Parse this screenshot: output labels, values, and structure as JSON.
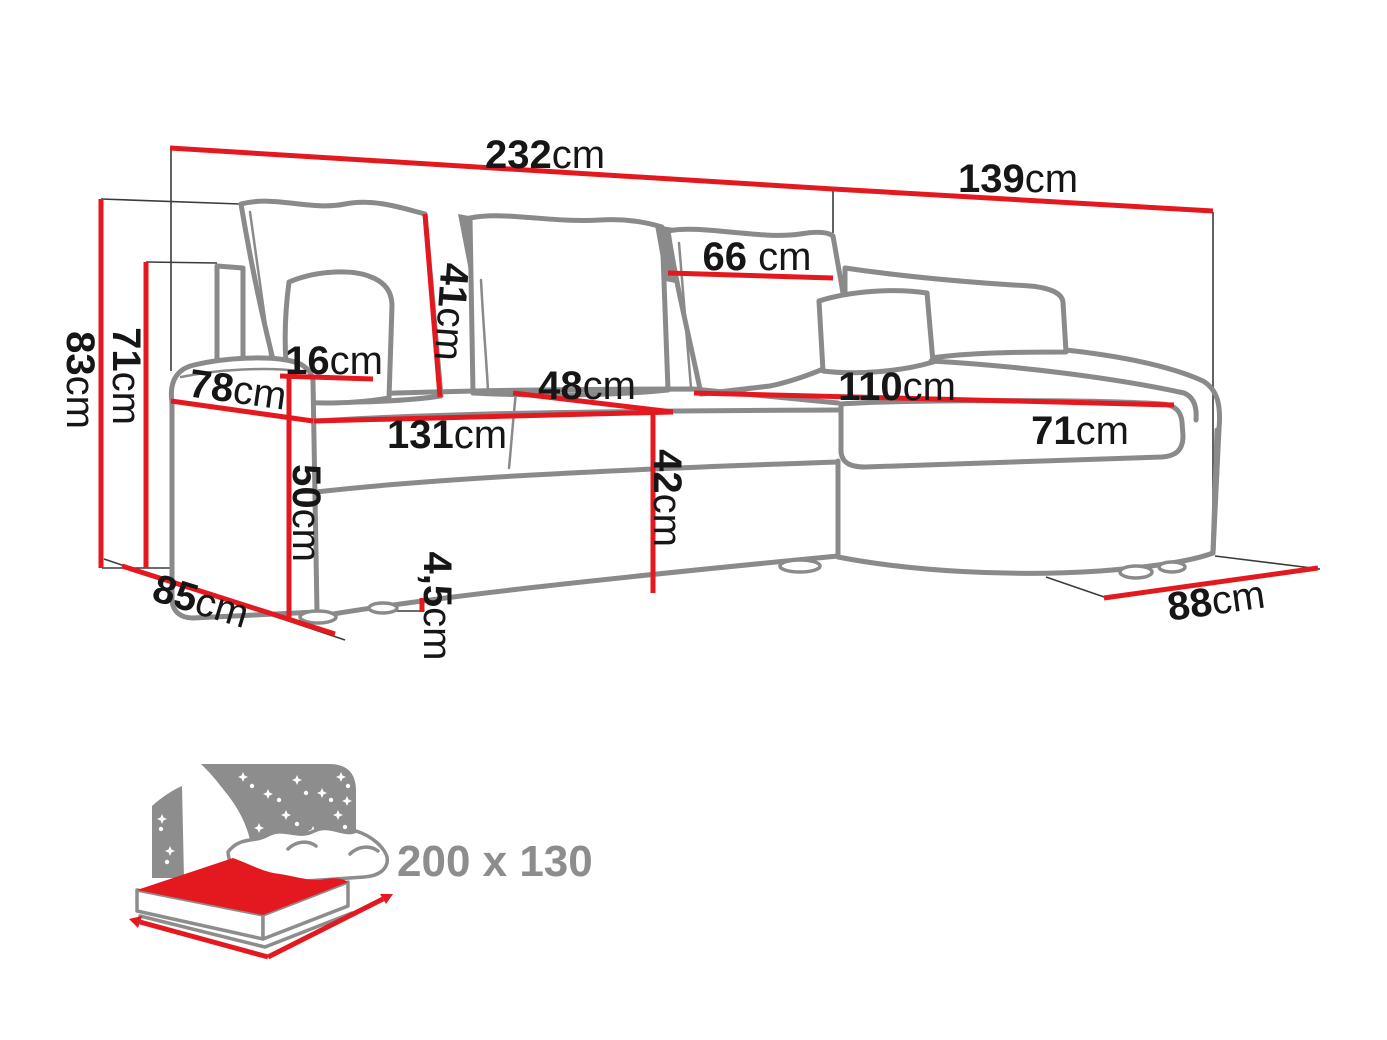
{
  "diagram": {
    "type": "corner-sofa-dimension-diagram",
    "unit": "cm",
    "colors": {
      "dimension_red": "#e4191f",
      "sofa_outline_gray": "#8a8a8a",
      "label_black": "#161616",
      "icon_gray": "#8d8d8d",
      "background": "#ffffff"
    },
    "dims": {
      "total_width": {
        "v": "232",
        "u": "cm"
      },
      "chaise_depth": {
        "v": "139",
        "u": "cm"
      },
      "back_cushion_width": {
        "v": "66",
        "u": " cm"
      },
      "back_cushion_height": {
        "v": "41",
        "u": "cm"
      },
      "armrest_top_width": {
        "v": "16",
        "u": "cm"
      },
      "armrest_depth": {
        "v": "78",
        "u": "cm"
      },
      "total_height": {
        "v": "83",
        "u": "cm"
      },
      "backrest_height": {
        "v": "71",
        "u": "cm"
      },
      "armrest_height": {
        "v": "50",
        "u": "cm"
      },
      "seat_width": {
        "v": "131",
        "u": "cm"
      },
      "seat_depth": {
        "v": "48",
        "u": "cm"
      },
      "seat_height": {
        "v": "42",
        "u": "cm"
      },
      "chaise_seat_length": {
        "v": "110",
        "u": "cm"
      },
      "chaise_seat_width": {
        "v": "71",
        "u": "cm"
      },
      "leg_height": {
        "v": "4,5",
        "u": "cm"
      },
      "base_depth": {
        "v": "85",
        "u": "cm"
      },
      "chaise_front_width": {
        "v": "88",
        "u": "cm"
      }
    },
    "sleeping": {
      "size": "200 x 130"
    }
  }
}
